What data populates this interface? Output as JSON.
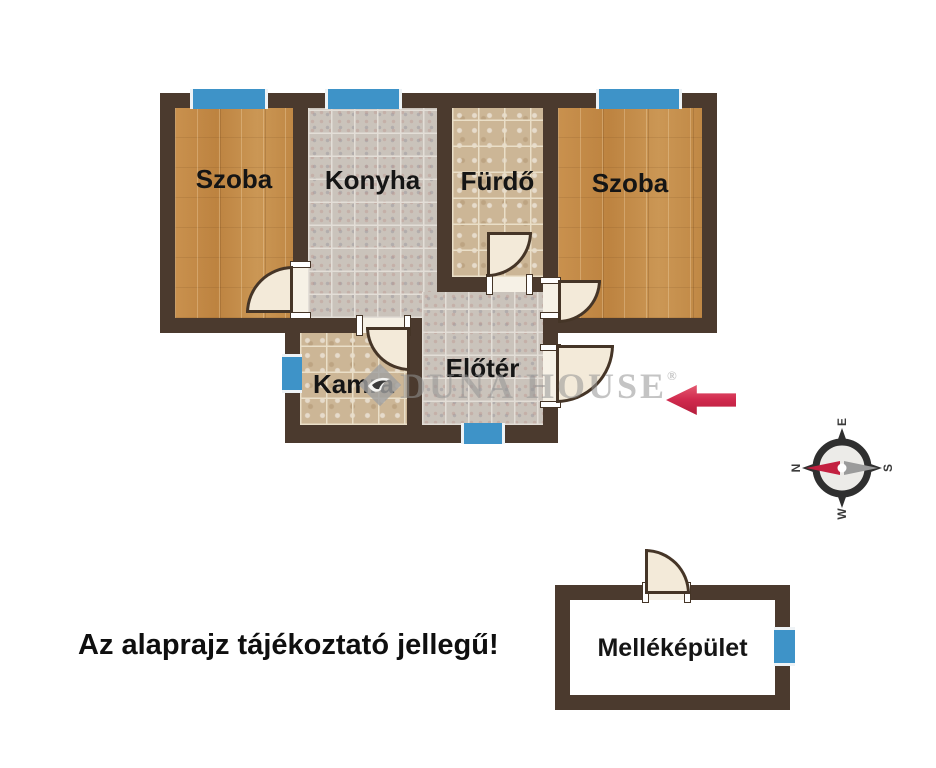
{
  "title": "Lakás alaprajz",
  "rooms": {
    "szoba_left": {
      "label": "Szoba"
    },
    "konyha": {
      "label": "Konyha"
    },
    "furdo": {
      "label": "Fürdő"
    },
    "szoba_right": {
      "label": "Szoba"
    },
    "kamra": {
      "label": "Kamra"
    },
    "eloter": {
      "label": "Előtér"
    },
    "mellekepulet": {
      "label": "Melléképület"
    }
  },
  "disclaimer": "Az alaprajz tájékoztató jellegű!",
  "watermark": {
    "brand": "DUNA HOUSE",
    "registered": "®"
  },
  "compass": {
    "north": "N",
    "east": "E",
    "south": "S",
    "west": "W"
  },
  "colors": {
    "wall": "#4b3a2e",
    "window_blue": "#3e93c8",
    "wood_floor": "#c48c48",
    "tile_gray": "#cac3bb",
    "tile_beige": "#ccb696",
    "door_leaf": "#f3ead9",
    "arrow_red": "#d12a4e",
    "compass_needle_red": "#c32040",
    "compass_needle_gray": "#9b9b9b"
  }
}
